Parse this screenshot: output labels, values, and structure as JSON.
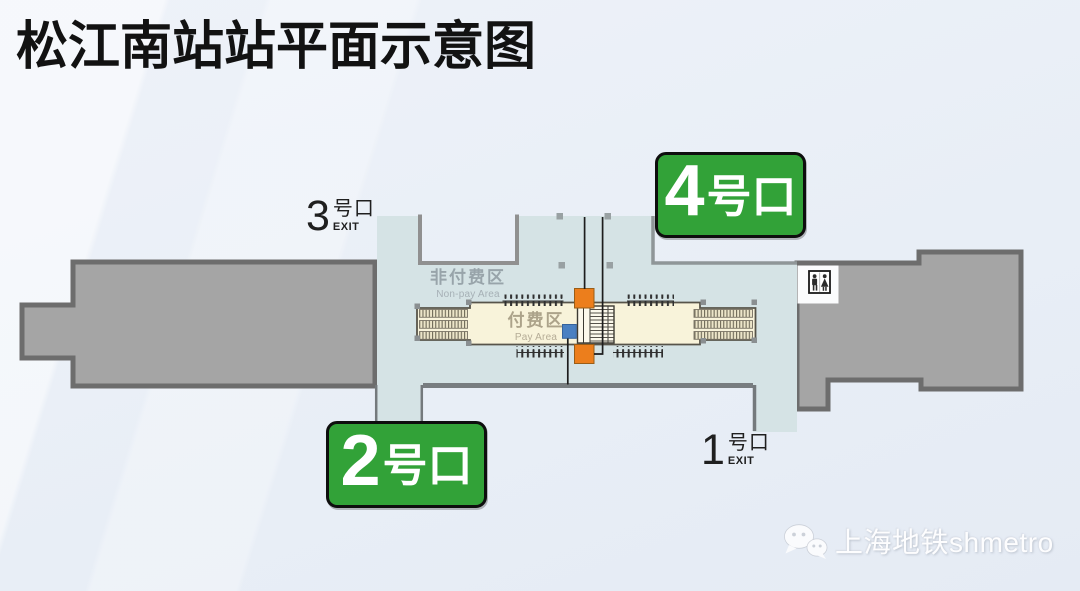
{
  "title": "松江南站站平面示意图",
  "station_map": {
    "areas": {
      "non_pay": {
        "zh": "非付费区",
        "en": "Non-pay Area"
      },
      "pay": {
        "zh": "付费区",
        "en": "Pay Area"
      }
    },
    "exits": {
      "exit3": {
        "number": "3",
        "suffix": "号口",
        "sub": "EXIT"
      },
      "exit1": {
        "number": "1",
        "suffix": "号口",
        "sub": "EXIT"
      },
      "badge4": {
        "number": "4",
        "suffix": "号口"
      },
      "badge2": {
        "number": "2",
        "suffix": "号口"
      }
    },
    "icons": {
      "restroom": "male-female-restroom-figures",
      "wechat": "two-chat-bubbles"
    },
    "colors": {
      "exit_badge_green": "#32a238",
      "escalator_box_orange": "#ec7e1c",
      "elevator_box_blue": "#4a80c2",
      "concourse_teal": "#d5e3e5",
      "platform_gray": "#a5a5a5",
      "paid_area_cream": "#f8f3da"
    }
  },
  "watermark": {
    "text": "上海地铁shmetro"
  }
}
